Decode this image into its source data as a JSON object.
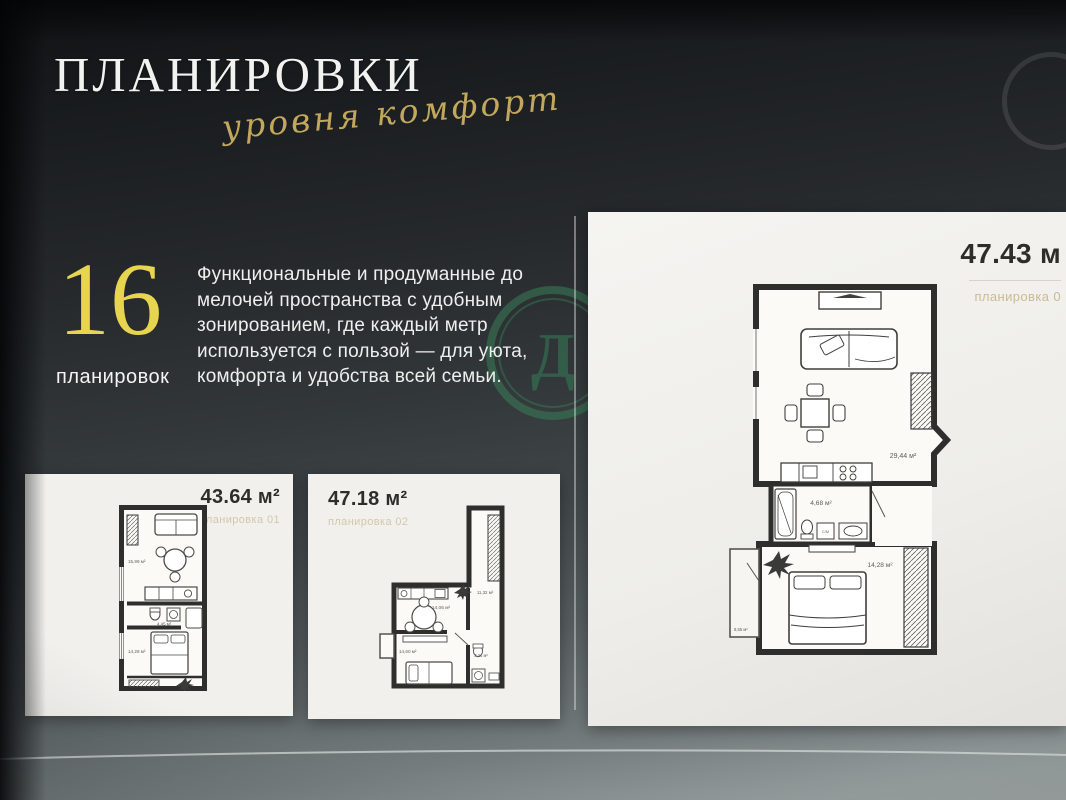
{
  "page": {
    "title": "ПЛАНИРОВКИ",
    "subtitle": "уровня комфорт",
    "stat": {
      "number": "16",
      "label": "планировок"
    },
    "description": "Функциональные и продуманные до мелочей пространства с удобным зонированием, где каждый метр используется с пользой — для уюта, комфорта и удобства всей семьи.",
    "watermark_letter": "Д"
  },
  "colors": {
    "script_gold": "#c3a75d",
    "stat_yellow": "#e7d44f",
    "plan_label_tan": "#bfa771",
    "watermark_green": "#387e57",
    "card_background": "#f1f0ed",
    "page_dark": "#1b1e20"
  },
  "cards": [
    {
      "area": "43.64 м²",
      "plan_label": "планировка 01",
      "rooms": {
        "living": "15,99 м²",
        "bath": "4,45 м²",
        "bedroom": "14,28 м²"
      }
    },
    {
      "area": "47.18 м²",
      "plan_label": "планировка 02",
      "rooms": {
        "kitchen_living": "14,06 м²",
        "hall": "11,32 м²",
        "bedroom": "14,60 м²",
        "bath": "3,21 м²"
      }
    },
    {
      "area": "47.43 м",
      "plan_label": "планировка 0",
      "rooms": {
        "kitchen_living": "29,44 м²",
        "bath": "4,68 м²",
        "bedroom": "14,28 м²",
        "balcony": "8,55 м²"
      },
      "washer_label": "С/М"
    }
  ]
}
